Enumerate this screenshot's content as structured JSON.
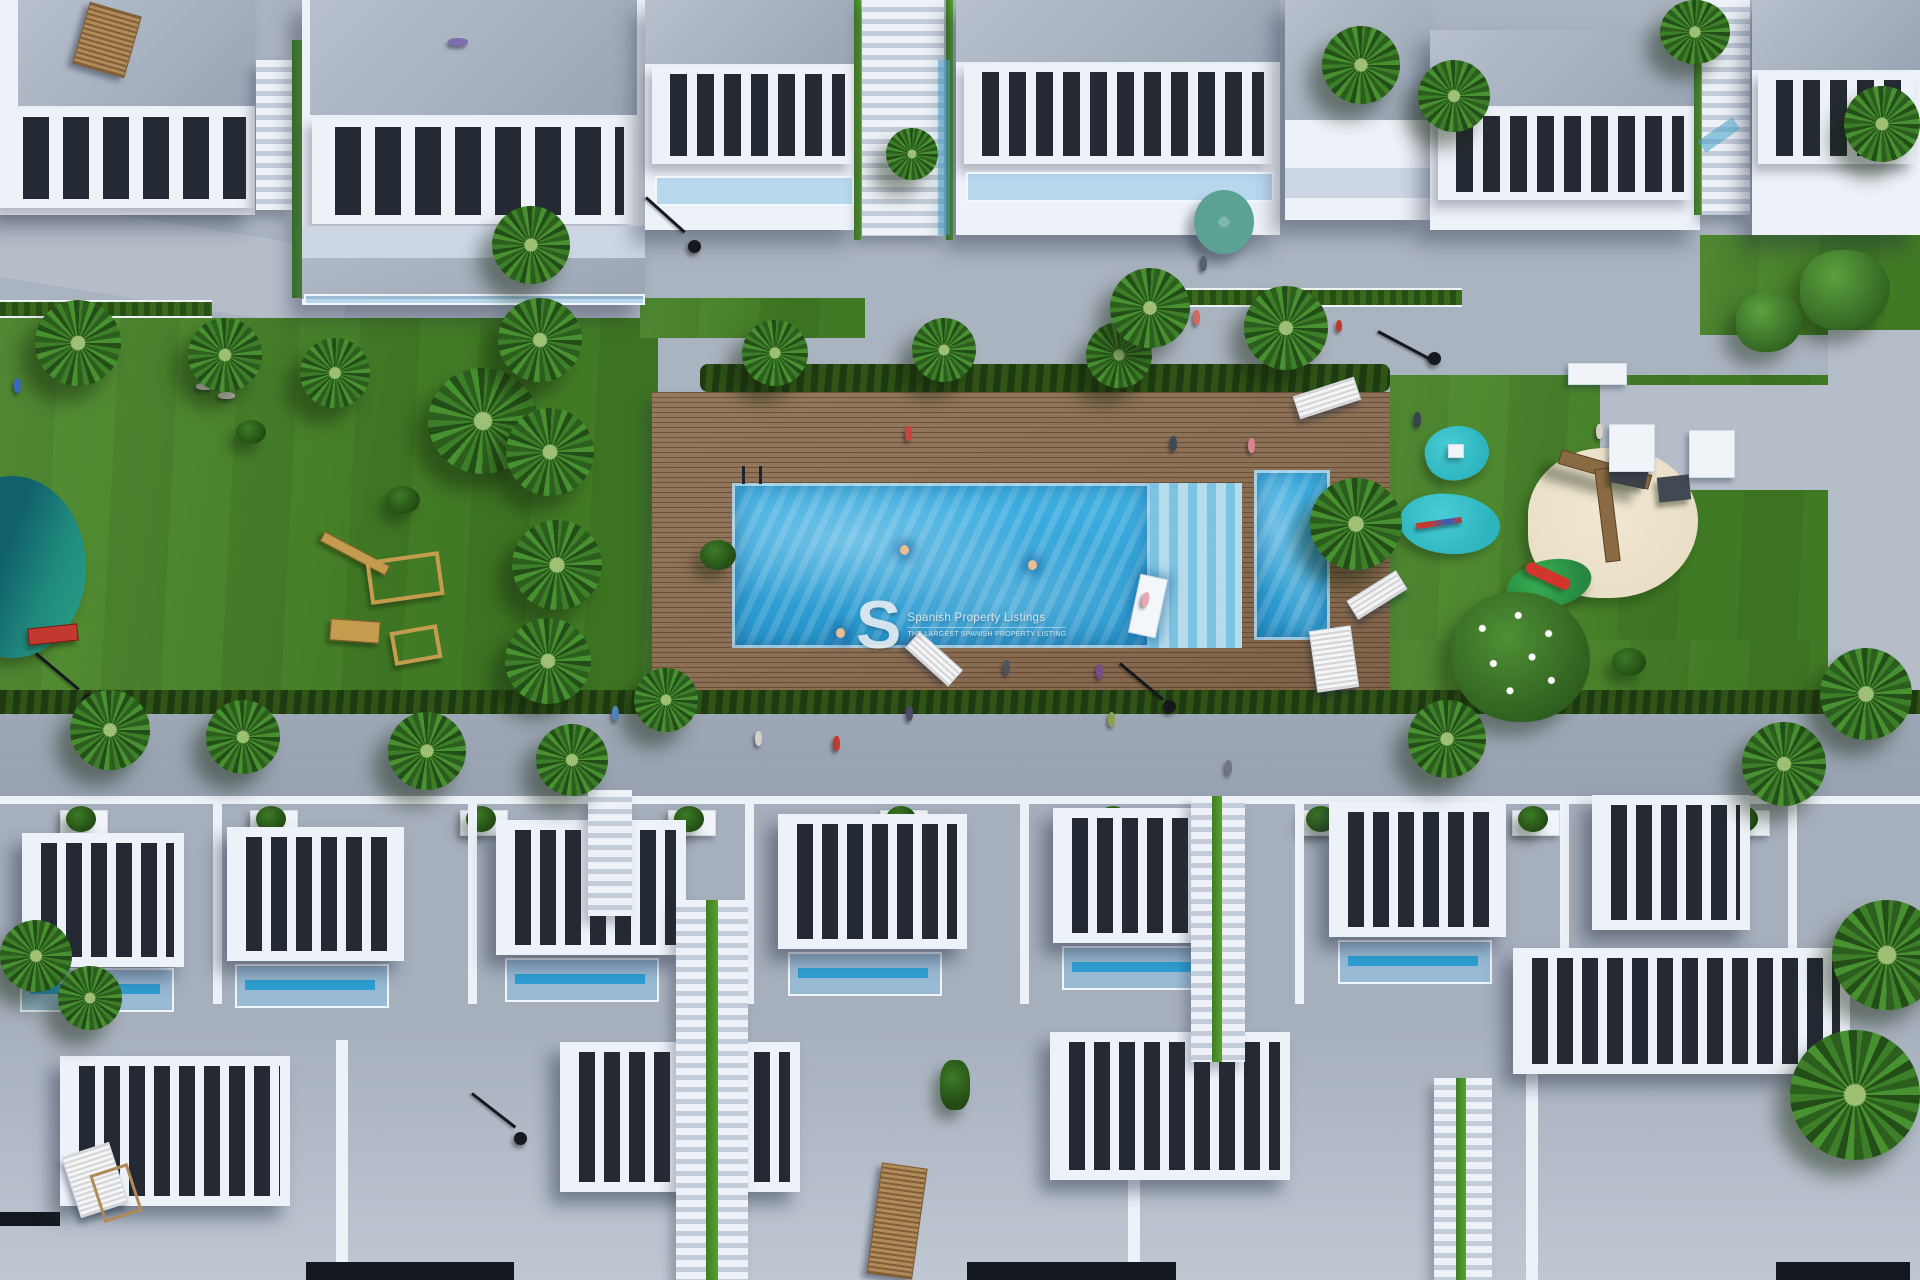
{
  "watermark": {
    "logo": "S",
    "title": "Spanish Property Listings",
    "subtitle": "THE LARGEST SPANISH PROPERTY LISTING"
  },
  "colors": {
    "pavement": "#aab3c0",
    "path": "#b5bdc9",
    "road": "#9da7b5",
    "wall": "#edf1f8",
    "wall-shade": "#ccd6e5",
    "roof": "#99a5b5",
    "roof-light": "#b7c0cc",
    "slat-gap": "#242a33",
    "grass": "#4a8829",
    "hedge": "#2e5417",
    "deck": "#8b6f55",
    "pool": "#41b2e4",
    "pool-deep": "#2795cb",
    "steps": "#7cc8e9",
    "pond": "#11616d",
    "pond-light": "#2aa38c",
    "rubber": "#2db4be",
    "sand": "#e9dec6",
    "parasol": "#5ba293",
    "wood": "#b08a58",
    "watermark": "#e9eef3"
  }
}
